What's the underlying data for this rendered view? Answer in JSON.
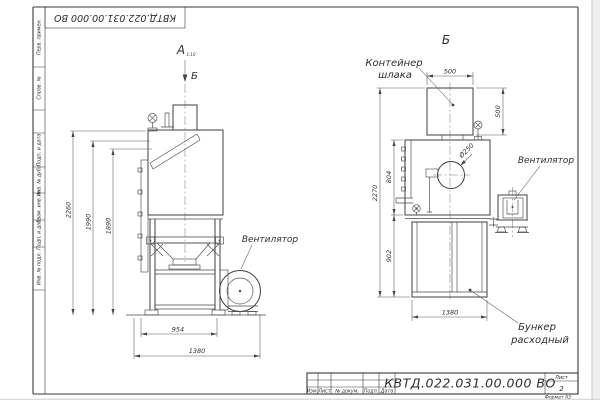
{
  "stamp": {
    "designation_rotated": "КВТД.022.031.00.000  ВО"
  },
  "frame": {
    "format_note": "Формат А3",
    "left_column": [
      {
        "label": "Перв. примен."
      },
      {
        "label": "Справ. №"
      },
      {
        "label": "Подп. и дата"
      },
      {
        "label": "Инв. № дубл."
      },
      {
        "label": "Взам. инв. №"
      },
      {
        "label": "Подп. и дата"
      },
      {
        "label": "Инв. № подл."
      }
    ]
  },
  "title_block": {
    "designation": "КВТД.022.031.00.000  ВО",
    "col_izm": "Изм.",
    "col_list": "Лист",
    "col_doc": "№ докум.",
    "col_podp": "Подп.",
    "col_data": "Дата",
    "sheet_label": "Лист",
    "sheet_number": "2"
  },
  "view_front": {
    "title": "А",
    "scale_note": "1:10",
    "section_label": "Б",
    "fan_label": "Вентилятор",
    "dim_2260": "2260",
    "dim_1990": "1990",
    "dim_1890": "1890",
    "dim_954": "954",
    "dim_1380": "1380"
  },
  "view_side": {
    "title": "Б",
    "container_line1": "Контейнер",
    "container_line2": "шлака",
    "fan_label": "Вентилятор",
    "hopper_line1": "Бункер",
    "hopper_line2": "расходный",
    "dim_500w": "500",
    "dim_500h": "500",
    "dim_d250": "Ø250",
    "dim_2270": "2270",
    "dim_804": "804",
    "dim_902": "902",
    "dim_1380": "1380"
  },
  "colors": {
    "line": "#3f3f3f",
    "dim": "#585858",
    "paper": "#ffffff"
  }
}
